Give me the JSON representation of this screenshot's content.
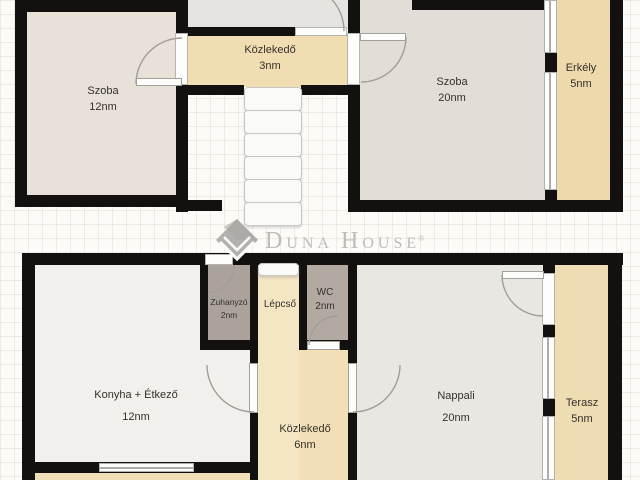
{
  "plan": {
    "floors": {
      "upper": {
        "rooms": {
          "szoba12": {
            "label": "Szoba",
            "area": "12nm"
          },
          "kozlekedo3": {
            "label": "Közlekedő",
            "area": "3nm"
          },
          "szoba20": {
            "label": "Szoba",
            "area": "20nm"
          },
          "erkely": {
            "label": "Erkély",
            "area": "5nm"
          }
        }
      },
      "lower": {
        "rooms": {
          "konyha": {
            "label": "Konyha + Étkező",
            "area": "12nm"
          },
          "zuhanyzo": {
            "label": "Zuhanyzó",
            "area": "2nm"
          },
          "lepcso": {
            "label": "Lépcső"
          },
          "wc": {
            "label": "WC",
            "area": "2nm"
          },
          "kozlekedo6": {
            "label": "Közlekedő",
            "area": "6nm"
          },
          "nappali": {
            "label": "Nappali",
            "area": "20nm"
          },
          "terasz": {
            "label": "Terasz",
            "area": "5nm"
          }
        }
      }
    }
  },
  "logo": {
    "part1": "D",
    "part2": "UNA",
    "part3": "H",
    "part4": "OUSE",
    "registered": "®"
  },
  "colors": {
    "wall": "#121110",
    "hall_beige": "#f1ddb2",
    "stair_beige": "#f5e6c3",
    "room_warm": "#e7e1d8",
    "room_gray": "#e2ddd6",
    "room_light": "#f1f0ec",
    "wet_gray": "#aba39b",
    "logo_gray": "#bdbcb9"
  }
}
